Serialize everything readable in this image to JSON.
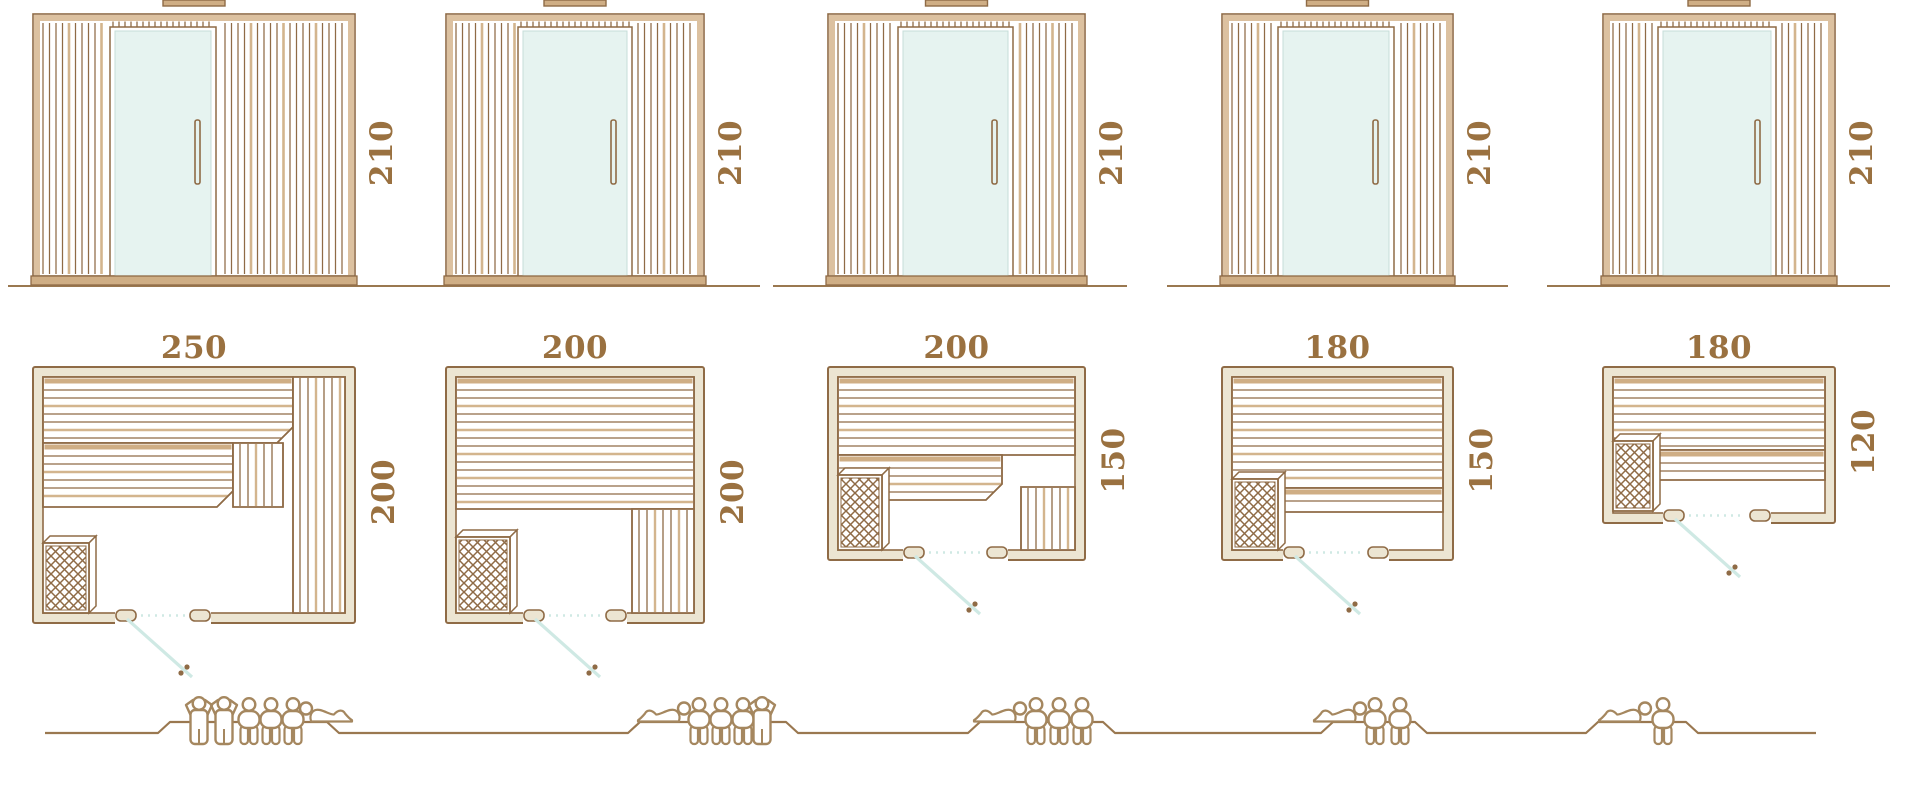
{
  "page": {
    "background": "#ffffff",
    "description": "Sauna model comparison diagram: five sauna models shown as front elevations with height dimension, floor plans with width and depth dimensions, and seating-capacity figures on a ground line"
  },
  "colors": {
    "line": "#8f6b46",
    "wall_fill": "#ece5d2",
    "tan": "#d3b58e",
    "tan_dark": "#cfae85",
    "band": "#dcc1a0",
    "glass": "#e6f3f0",
    "glass_edge": "#c5ded8",
    "teal": "#cfe9e4",
    "label": "#9a7140",
    "people": "#a5875f",
    "ground": "#9a7850"
  },
  "saunas": [
    {
      "name": "sauna-250x200",
      "front": {
        "height_label": "210"
      },
      "plan": {
        "width_label": "250",
        "depth_label": "200"
      },
      "capacity": 6,
      "people": [
        "standing",
        "standing",
        "sitting",
        "sitting",
        "sitting",
        "lying"
      ],
      "layout": {
        "x": 33,
        "w": 322,
        "d": 256,
        "door_off": 82,
        "door_w": 96,
        "benches": [
          {
            "o": "h",
            "x": 10,
            "y": 10,
            "w": 250,
            "h": 66,
            "cut": 1
          },
          {
            "o": "v",
            "x": 260,
            "y": 10,
            "w": 52,
            "h": 236
          },
          {
            "o": "h",
            "x": 10,
            "y": 76,
            "w": 190,
            "h": 64,
            "cut": 1
          },
          {
            "o": "v",
            "x": 200,
            "y": 76,
            "w": 50,
            "h": 64
          }
        ],
        "heater": {
          "x": 10,
          "y": 176,
          "w": 46,
          "h": 70
        },
        "figures": [
          {
            "t": "standing",
            "x": 199
          },
          {
            "t": "standing",
            "x": 224
          },
          {
            "t": "sitting",
            "x": 249
          },
          {
            "t": "sitting",
            "x": 271
          },
          {
            "t": "sitting",
            "x": 293
          },
          {
            "t": "lying",
            "x": 306,
            "dir": 1
          }
        ]
      }
    },
    {
      "name": "sauna-200x200",
      "front": {
        "height_label": "210"
      },
      "plan": {
        "width_label": "200",
        "depth_label": "200"
      },
      "capacity": 5,
      "people": [
        "lying",
        "sitting",
        "sitting",
        "sitting",
        "standing"
      ],
      "layout": {
        "x": 446,
        "w": 258,
        "d": 256,
        "door_off": 77,
        "door_w": 104,
        "benches": [
          {
            "o": "h",
            "x": 10,
            "y": 10,
            "w": 238,
            "h": 132
          },
          {
            "o": "v",
            "x": 186,
            "y": 142,
            "w": 62,
            "h": 104
          }
        ],
        "heater": {
          "x": 10,
          "y": 170,
          "w": 54,
          "h": 76
        },
        "figures": [
          {
            "t": "lying",
            "x": 684,
            "dir": -1
          },
          {
            "t": "sitting",
            "x": 699
          },
          {
            "t": "sitting",
            "x": 721
          },
          {
            "t": "sitting",
            "x": 743
          },
          {
            "t": "standing",
            "x": 762
          }
        ]
      }
    },
    {
      "name": "sauna-200x150",
      "front": {
        "height_label": "210"
      },
      "plan": {
        "width_label": "200",
        "depth_label": "150"
      },
      "capacity": 4,
      "people": [
        "lying",
        "sitting",
        "sitting",
        "sitting"
      ],
      "layout": {
        "x": 828,
        "w": 257,
        "d": 193,
        "door_off": 75,
        "door_w": 105,
        "benches": [
          {
            "o": "h",
            "x": 10,
            "y": 10,
            "w": 237,
            "h": 78
          },
          {
            "o": "h",
            "x": 10,
            "y": 88,
            "w": 164,
            "h": 45,
            "cut": 1
          },
          {
            "o": "v",
            "x": 193,
            "y": 120,
            "w": 54,
            "h": 63
          }
        ],
        "heater": {
          "x": 10,
          "y": 108,
          "w": 44,
          "h": 75
        },
        "figures": [
          {
            "t": "lying",
            "x": 1020,
            "dir": -1
          },
          {
            "t": "sitting",
            "x": 1036
          },
          {
            "t": "sitting",
            "x": 1059
          },
          {
            "t": "sitting",
            "x": 1082
          }
        ]
      }
    },
    {
      "name": "sauna-180x150",
      "front": {
        "height_label": "210"
      },
      "plan": {
        "width_label": "180",
        "depth_label": "150"
      },
      "capacity": 3,
      "people": [
        "lying",
        "sitting",
        "sitting"
      ],
      "layout": {
        "x": 1222,
        "w": 231,
        "d": 193,
        "door_off": 61,
        "door_w": 106,
        "benches": [
          {
            "o": "h",
            "x": 10,
            "y": 10,
            "w": 211,
            "h": 111
          },
          {
            "o": "h",
            "x": 61,
            "y": 121,
            "w": 160,
            "h": 24
          }
        ],
        "heater": {
          "x": 10,
          "y": 112,
          "w": 46,
          "h": 71
        },
        "figures": [
          {
            "t": "lying",
            "x": 1360,
            "dir": -1
          },
          {
            "t": "sitting",
            "x": 1375
          },
          {
            "t": "sitting",
            "x": 1400
          }
        ]
      }
    },
    {
      "name": "sauna-180x120",
      "front": {
        "height_label": "210"
      },
      "plan": {
        "width_label": "180",
        "depth_label": "120"
      },
      "capacity": 2,
      "people": [
        "lying",
        "sitting"
      ],
      "layout": {
        "x": 1603,
        "w": 232,
        "d": 156,
        "door_off": 60,
        "door_w": 108,
        "benches": [
          {
            "o": "h",
            "x": 10,
            "y": 10,
            "w": 212,
            "h": 73
          },
          {
            "o": "h",
            "x": 55,
            "y": 83,
            "w": 167,
            "h": 30
          }
        ],
        "heater": {
          "x": 10,
          "y": 74,
          "w": 40,
          "h": 70
        },
        "figures": [
          {
            "t": "lying",
            "x": 1645,
            "dir": -1
          },
          {
            "t": "sitting",
            "x": 1663
          }
        ]
      }
    }
  ],
  "ground": {
    "start": 45,
    "end": 1816,
    "base_y": 733,
    "platform_y": 722,
    "bumps": [
      [
        170,
        327
      ],
      [
        640,
        786
      ],
      [
        980,
        1103
      ],
      [
        1333,
        1415
      ],
      [
        1598,
        1686
      ]
    ]
  },
  "elevation_ground": {
    "y": 286,
    "segments": [
      [
        8,
        760
      ],
      [
        773,
        1127
      ],
      [
        1167,
        1508
      ],
      [
        1547,
        1890
      ]
    ]
  }
}
